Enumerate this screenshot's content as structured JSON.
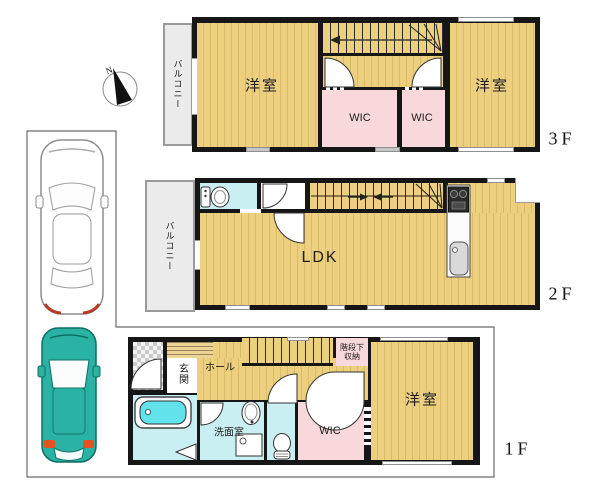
{
  "compass": {
    "north_label": "N"
  },
  "floor3": {
    "label": "3F",
    "balcony": "バルコニー",
    "room_left": "洋室",
    "wic_left": "WIC",
    "wic_right": "WIC",
    "room_right": "洋室"
  },
  "floor2": {
    "label": "2F",
    "balcony": "バルコニー",
    "ldk": "LDK"
  },
  "floor1": {
    "label": "1F",
    "entrance": "玄関",
    "hall": "ホール",
    "stair_storage_line1": "階段下",
    "stair_storage_line2": "収納",
    "washroom": "洗面室",
    "wic": "WIC",
    "room": "洋室"
  },
  "colors": {
    "wall": "#161616",
    "room_yellow": "#eccf7f",
    "room_pink": "#f8d8da",
    "room_cyan": "#c9eff2",
    "balcony_gray": "#ebebeb",
    "car_teal": "#2ab3a4",
    "bathtub_cyan": "#62e2ea"
  }
}
